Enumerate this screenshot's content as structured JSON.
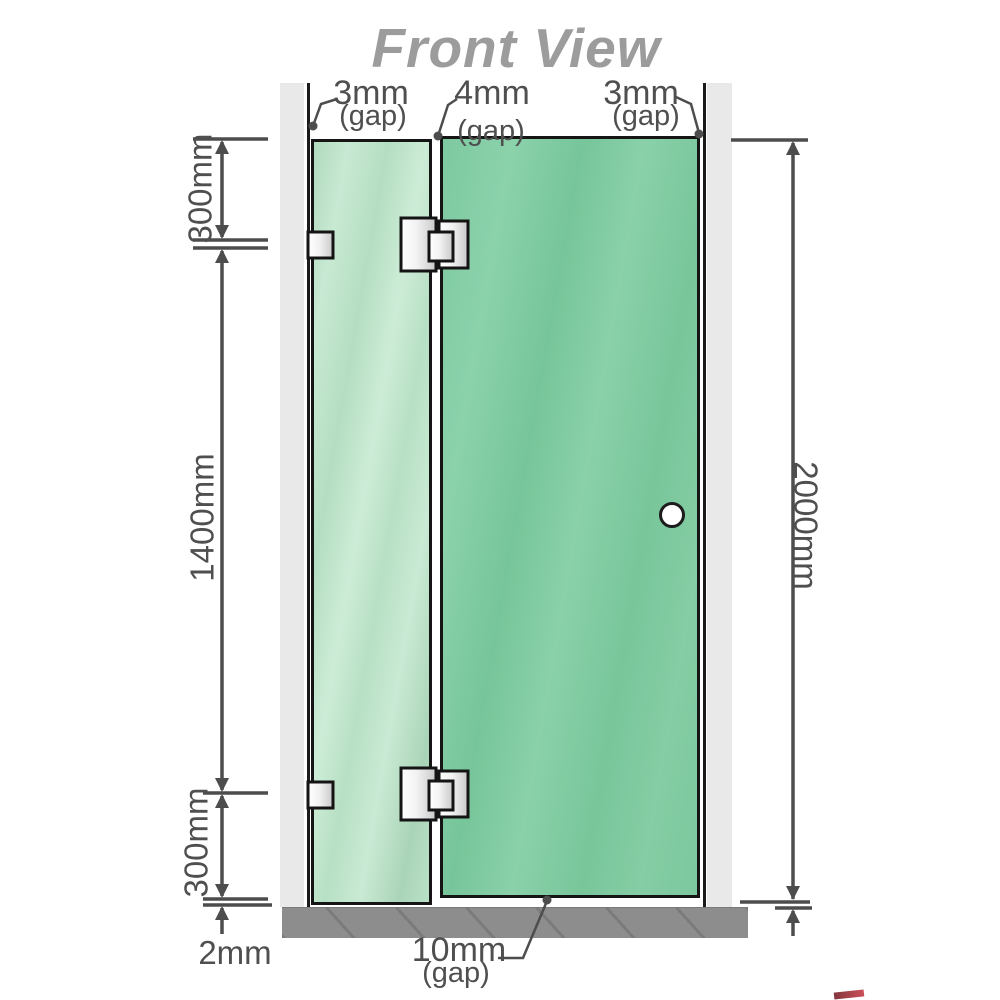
{
  "title": "Front View",
  "labels": {
    "gap_left": {
      "value": "3mm",
      "note": "(gap)"
    },
    "gap_panel": {
      "value": "4mm",
      "note": "(gap)"
    },
    "gap_right": {
      "value": "3mm",
      "note": "(gap)"
    },
    "gap_door_bottom": {
      "value": "10mm",
      "note": "(gap)"
    },
    "section_top": "300mm",
    "section_middle": "1400mm",
    "section_bottom": "300mm",
    "floor_clearance": "2mm",
    "total_height": "2000mm"
  },
  "colors": {
    "glass_fixed_panel": "#b5dfc2",
    "glass_door": "#7cc89e",
    "wall": "#e9e9e9",
    "floor": "#8d8d8d",
    "linework": "#4d4d4d",
    "title_gray": "#9c9c9c",
    "hardware_silver": "#e8e8e8",
    "outline_black": "#151515"
  }
}
